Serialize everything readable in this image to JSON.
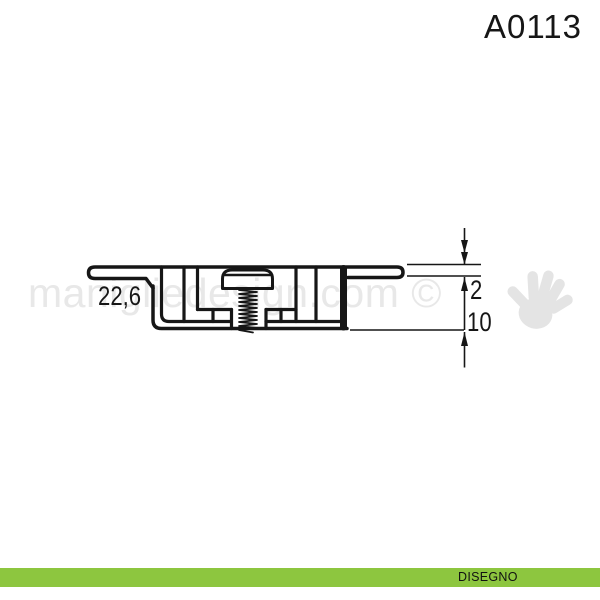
{
  "page": {
    "title": "A0113"
  },
  "watermark": {
    "text": "manigliedesign.com ©",
    "text_color": "#e8e8e8",
    "hand_icon_color": "#e4e4e4"
  },
  "drawing": {
    "line_color": "#161616",
    "dimensions": {
      "flange_width": "22,6",
      "flange_thickness": "2",
      "body_height": "10"
    }
  },
  "footer": {
    "label": "DISEGNO",
    "bar_color": "#8dc63f",
    "text_color": "#111111"
  }
}
